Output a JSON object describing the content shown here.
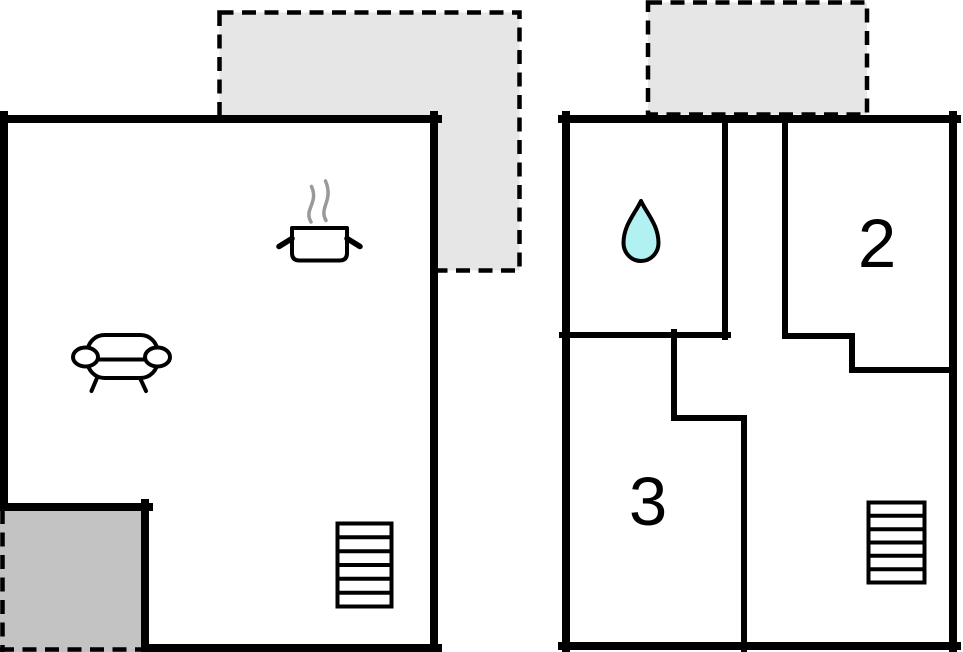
{
  "title": "Two-storey holiday house floor plan",
  "colors": {
    "background": "#ffffff",
    "wall": "#000000",
    "floor_fill": "#ffffff",
    "terrace_fill": "#e6e6e6",
    "patio_fill": "#c3c3c3",
    "water_drop_fill": "#b2f1f1",
    "steam": "#999999",
    "label": "#000000"
  },
  "ground_floor": {
    "name": "ground floor",
    "areas": [
      {
        "id": "terrace-top",
        "style": "dashed-outline",
        "icon": "terrace-area"
      },
      {
        "id": "living-kitchen",
        "label": "",
        "icons": [
          "cooking-pot-icon",
          "steam-icon",
          "sofa-icon",
          "stairs-icon"
        ]
      },
      {
        "id": "patio-corner",
        "style": "dashed-outline",
        "icon": "patio-area"
      }
    ]
  },
  "upper_floor": {
    "name": "upper floor",
    "rooms": [
      {
        "id": "bathroom",
        "label": "",
        "icon": "water-drop-icon"
      },
      {
        "id": "bedroom-2",
        "label": "2"
      },
      {
        "id": "bedroom-3",
        "label": "3"
      },
      {
        "id": "landing",
        "label": "",
        "icon": "stairs-icon"
      },
      {
        "id": "balcony-top",
        "label": "",
        "style": "dashed-outline",
        "icon": "terrace-area"
      }
    ]
  }
}
